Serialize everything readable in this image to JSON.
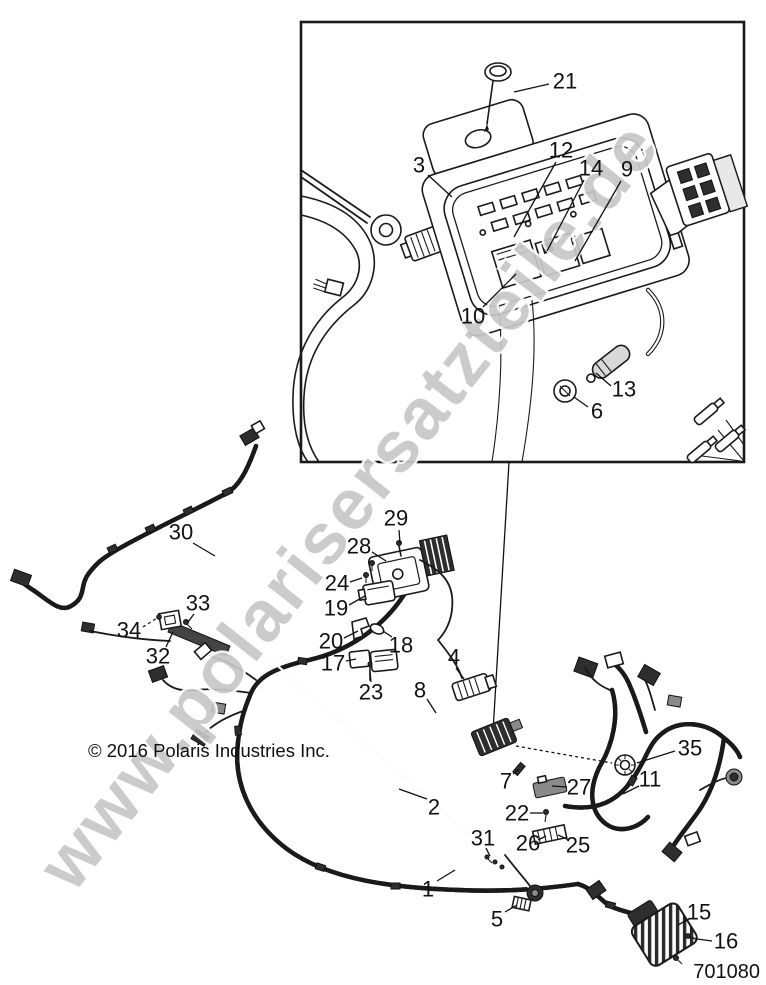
{
  "figure": {
    "copyright": "© 2016 Polaris Industries Inc.",
    "part_number": "701080",
    "watermark": "www.polarisersatzteile.de"
  },
  "callouts": [
    {
      "n": "21",
      "label": [
        565,
        81
      ],
      "leader": [
        549,
        84,
        514,
        92
      ]
    },
    {
      "n": "3",
      "label": [
        419,
        165
      ],
      "leader": [
        428,
        175,
        452,
        197
      ]
    },
    {
      "n": "12",
      "label": [
        561,
        150
      ],
      "leader": [
        556,
        162,
        514,
        237
      ]
    },
    {
      "n": "14",
      "label": [
        591,
        168
      ],
      "leader": [
        584,
        180,
        547,
        251
      ]
    },
    {
      "n": "9",
      "label": [
        627,
        169
      ],
      "leader": [
        621,
        181,
        575,
        261
      ]
    },
    {
      "n": "10",
      "label": [
        473,
        316
      ],
      "leader": [
        483,
        307,
        516,
        274
      ]
    },
    {
      "n": "13",
      "label": [
        624,
        389
      ],
      "leader": [
        611,
        386,
        596,
        373
      ]
    },
    {
      "n": "6",
      "label": [
        597,
        411
      ],
      "leader": [
        588,
        407,
        574,
        397
      ]
    },
    {
      "n": "30",
      "label": [
        181,
        532
      ],
      "leader": [
        193,
        543,
        215,
        556
      ]
    },
    {
      "n": "29",
      "label": [
        396,
        518
      ],
      "leader": [
        399,
        530,
        400,
        543
      ]
    },
    {
      "n": "28",
      "label": [
        359,
        546
      ],
      "leader": [
        372,
        552,
        386,
        561
      ]
    },
    {
      "n": "24",
      "label": [
        337,
        583
      ],
      "leader": [
        350,
        582,
        362,
        578
      ]
    },
    {
      "n": "19",
      "label": [
        336,
        608
      ],
      "leader": [
        349,
        605,
        365,
        596
      ]
    },
    {
      "n": "33",
      "label": [
        198,
        603
      ],
      "leader": [
        194,
        614,
        188,
        622
      ]
    },
    {
      "n": "34",
      "label": [
        129,
        630
      ],
      "leader": [
        143,
        627,
        157,
        618
      ],
      "dashed": true
    },
    {
      "n": "32",
      "label": [
        158,
        656
      ],
      "leader": [
        166,
        647,
        173,
        632
      ]
    },
    {
      "n": "20",
      "label": [
        331,
        641
      ],
      "leader": [
        344,
        638,
        358,
        631
      ]
    },
    {
      "n": "17",
      "label": [
        333,
        663
      ],
      "leader": [
        346,
        661,
        356,
        659
      ]
    },
    {
      "n": "18",
      "label": [
        401,
        645
      ],
      "leader": [
        392,
        637,
        383,
        631
      ]
    },
    {
      "n": "23",
      "label": [
        371,
        692
      ],
      "leader": [
        371,
        682,
        370,
        672
      ]
    },
    {
      "n": "4",
      "label": [
        454,
        657
      ],
      "leader": [
        456,
        668,
        464,
        679
      ]
    },
    {
      "n": "8",
      "label": [
        420,
        690
      ],
      "leader": [
        427,
        699,
        436,
        713
      ]
    },
    {
      "n": "2",
      "label": [
        434,
        807
      ],
      "leader": [
        427,
        799,
        399,
        789
      ]
    },
    {
      "n": "7",
      "label": [
        506,
        781
      ],
      "leader": [
        513,
        774,
        519,
        769
      ]
    },
    {
      "n": "27",
      "label": [
        579,
        787
      ],
      "leader": [
        567,
        787,
        552,
        786
      ]
    },
    {
      "n": "22",
      "label": [
        517,
        813
      ],
      "leader": [
        530,
        813,
        543,
        813
      ]
    },
    {
      "n": "26",
      "label": [
        528,
        843
      ],
      "leader": [
        538,
        840,
        546,
        836
      ]
    },
    {
      "n": "25",
      "label": [
        578,
        845
      ],
      "leader": [
        569,
        840,
        558,
        835
      ]
    },
    {
      "n": "31",
      "label": [
        483,
        838
      ],
      "leader": [
        486,
        848,
        490,
        856
      ]
    },
    {
      "n": "35",
      "label": [
        690,
        748
      ],
      "leader": [
        675,
        751,
        637,
        763
      ]
    },
    {
      "n": "11",
      "label": [
        650,
        779
      ],
      "leader": [
        639,
        786,
        623,
        794
      ]
    },
    {
      "n": "1",
      "label": [
        428,
        889
      ],
      "leader": [
        437,
        881,
        455,
        870
      ]
    },
    {
      "n": "5",
      "label": [
        497,
        919
      ],
      "leader": [
        505,
        912,
        517,
        905
      ]
    },
    {
      "n": "15",
      "label": [
        699,
        912
      ],
      "leader": [
        689,
        919,
        678,
        925
      ]
    },
    {
      "n": "16",
      "label": [
        726,
        941
      ],
      "leader": [
        712,
        941,
        697,
        939
      ]
    }
  ]
}
